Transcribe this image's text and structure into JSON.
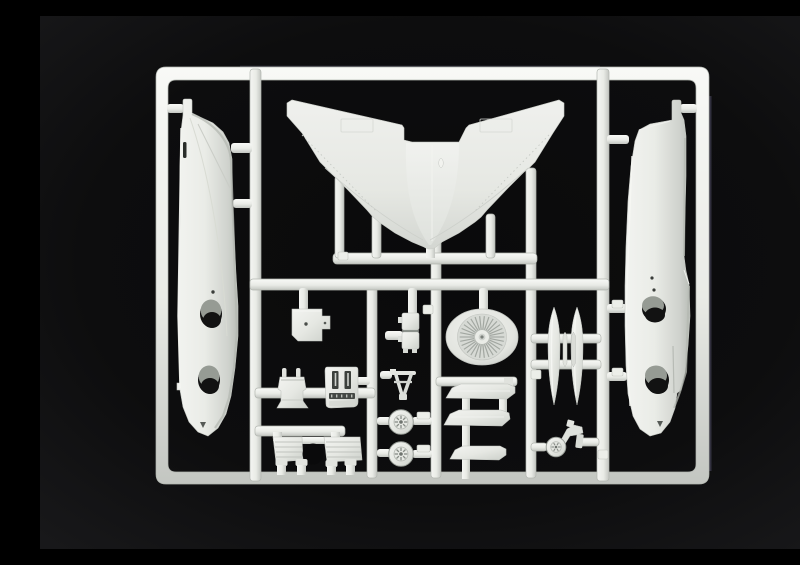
{
  "scene": {
    "type": "photograph",
    "description": "Injection-moulded sprue (parts tree) of a model aircraft kit: white-grey polystyrene runner frame holding two fuselage halves, a one-piece swept lower wing, an engine intake fan, drop-tank halves, wheels, cockpit parts and landing-gear parts, photographed on a black background"
  },
  "colors": {
    "background": "#0a0a0b",
    "background_edge": "#19191b",
    "plastic": "#e9ebe6",
    "plastic_highlight": "#f8f9f6",
    "plastic_shadow": "#c3c6c1",
    "plastic_dark": "#9aa09a",
    "hole_gray": "#969b94",
    "hole_dark": "#121212",
    "fringe": "#8d87b8"
  },
  "counts": {
    "fan_blades": 30,
    "main_wheel_spokes": 8,
    "nose_wheel_spokes": 6,
    "main_wheels": 2,
    "drop_tank_halves": 2,
    "airbrake_actuators": 4
  },
  "parts": [
    {
      "id": "sprue-frame",
      "label": "runner frame with internal runners and gates"
    },
    {
      "id": "fuselage-half-left",
      "label": "left fuselage half (vertical, nose down)"
    },
    {
      "id": "fuselage-half-right",
      "label": "right fuselage half (vertical, nose down)"
    },
    {
      "id": "wing-lower",
      "label": "one-piece swept lower wing"
    },
    {
      "id": "engine-fan",
      "label": "engine intake fan disc"
    },
    {
      "id": "drop-tanks",
      "label": "two drop-tank halves with small fins"
    },
    {
      "id": "main-wheels",
      "label": "two main wheels"
    },
    {
      "id": "nose-gear",
      "label": "nose gear leg with wheel"
    },
    {
      "id": "ejection-seat",
      "label": "ejection seat"
    },
    {
      "id": "instrument-panel",
      "label": "instrument panel with decal detail"
    },
    {
      "id": "cockpit-tub",
      "label": "cockpit tub box"
    },
    {
      "id": "equipment-box",
      "label": "equipment box part"
    },
    {
      "id": "gunsight-frame",
      "label": "small A-frame part"
    },
    {
      "id": "stabilizer-parts",
      "label": "three angular stabilizer / airbrake plates"
    },
    {
      "id": "airbrake-assembly",
      "label": "ribbed airbrake plates with four actuators"
    }
  ]
}
